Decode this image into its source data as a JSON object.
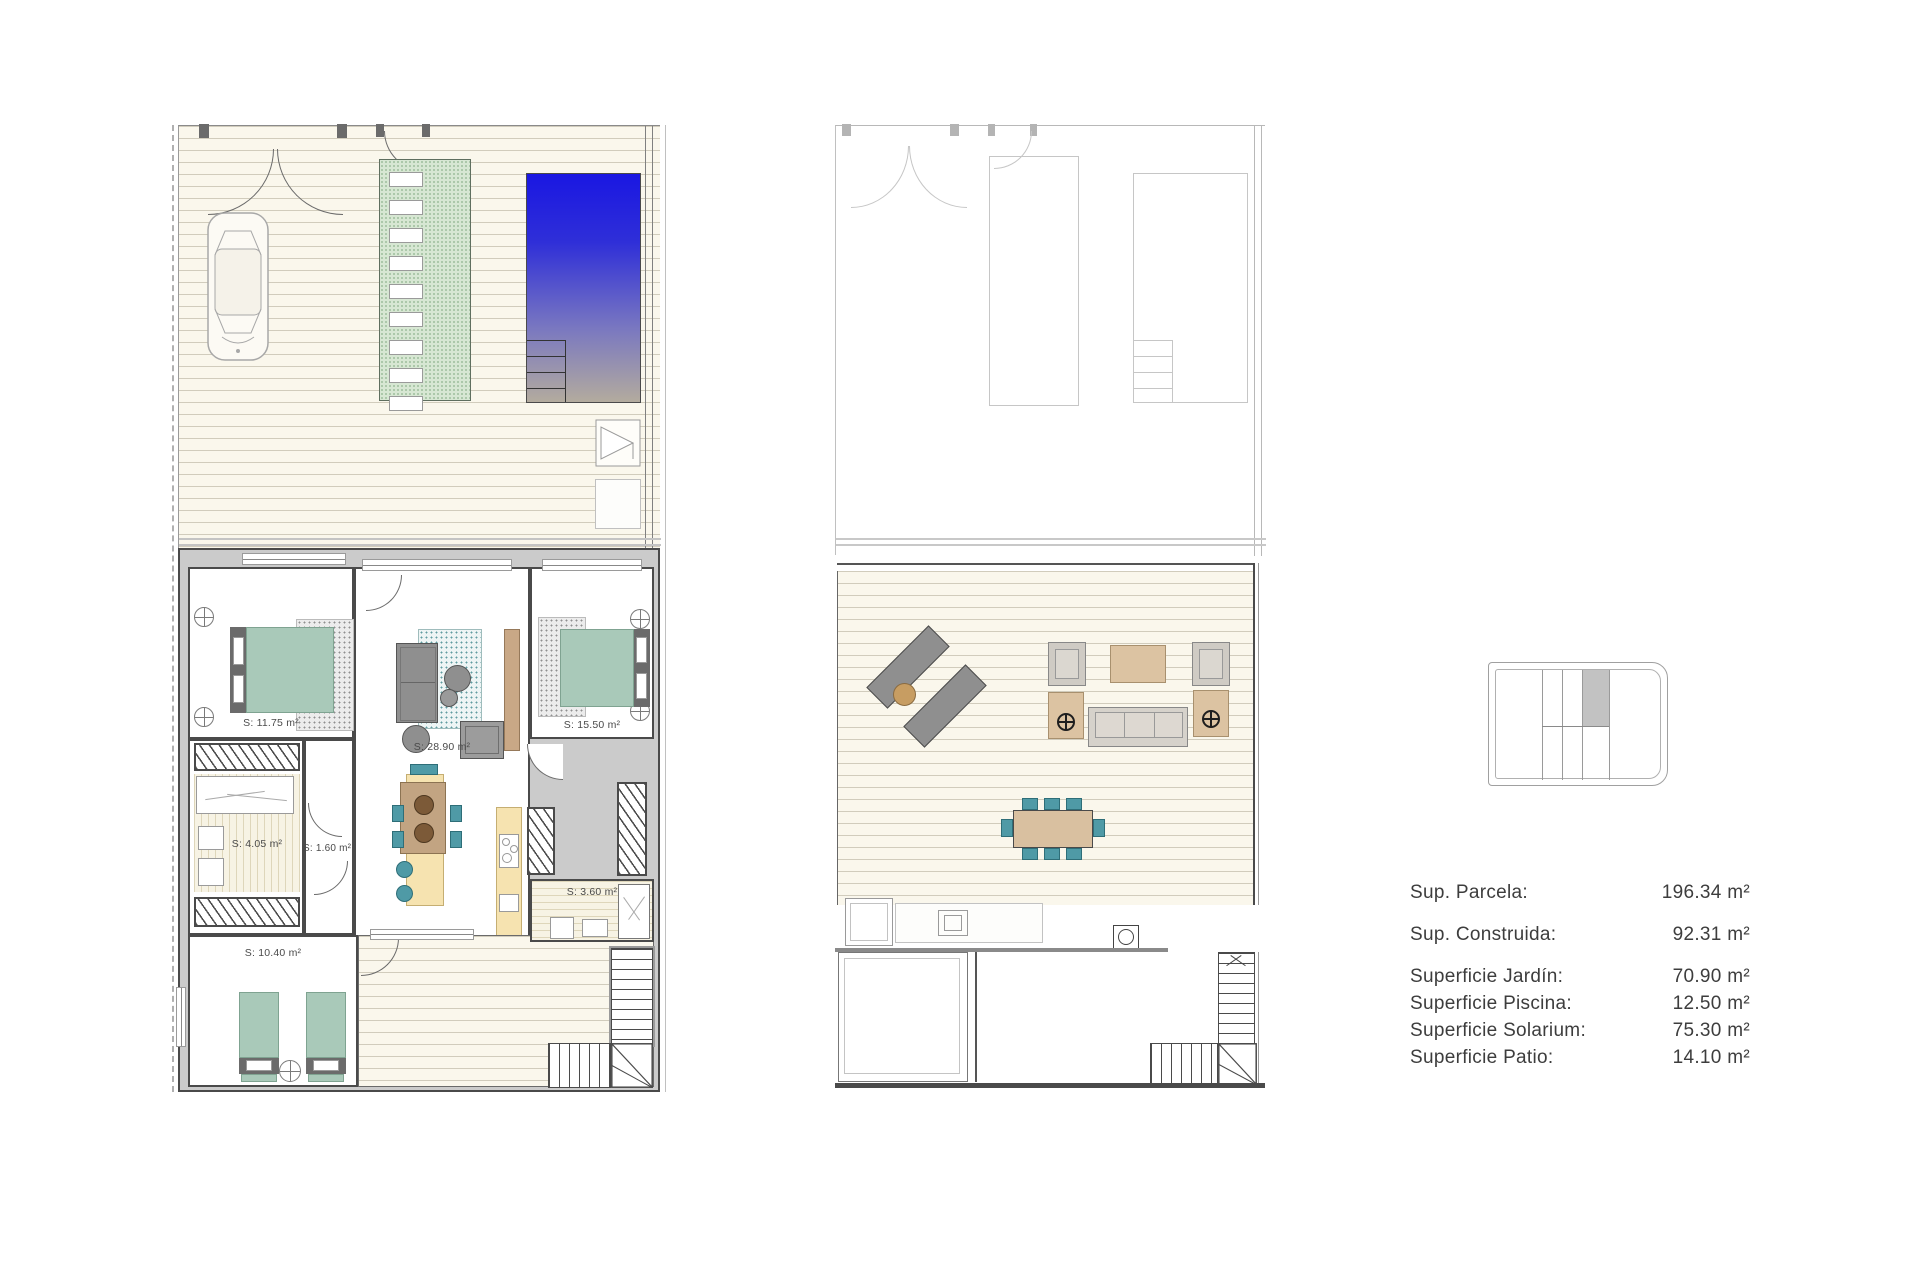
{
  "plans": {
    "ground_floor": {
      "rooms": [
        {
          "id": "bedroom-1",
          "label": "S: 11.75 m²"
        },
        {
          "id": "living-room",
          "label": "S: 28.90 m²"
        },
        {
          "id": "bedroom-2",
          "label": "S: 15.50 m²"
        },
        {
          "id": "bathroom-1",
          "label": "S: 4.05 m²"
        },
        {
          "id": "hall",
          "label": "S: 1.60 m²"
        },
        {
          "id": "bathroom-2",
          "label": "S: 3.60 m²"
        },
        {
          "id": "bedroom-3",
          "label": "S: 10.40 m²"
        }
      ]
    }
  },
  "legend": {
    "rows": [
      {
        "label": "Sup. Parcela:",
        "value": "196.34 m²"
      },
      {
        "label": "Sup. Construida:",
        "value": "92.31 m²"
      },
      {
        "label": "Superficie Jardín:",
        "value": "70.90 m²"
      },
      {
        "label": "Superficie Piscina:",
        "value": "12.50 m²"
      },
      {
        "label": "Superficie Solarium:",
        "value": "75.30 m²"
      },
      {
        "label": "Superficie Patio:",
        "value": "14.10 m²"
      }
    ]
  },
  "colors": {
    "pool_top": "#1a17e2",
    "pool_bottom": "#b3ab9e",
    "path_green": "#d7e7d3",
    "bed_green": "#a9c9b9",
    "chair_teal": "#4f9aa6",
    "kitchen_cream": "#f6e3b0",
    "wood_tan": "#c2a482",
    "furniture_gray": "#8f8f8f",
    "wall_gray": "#cbcbcb",
    "deck_line": "#dcd8c4"
  }
}
